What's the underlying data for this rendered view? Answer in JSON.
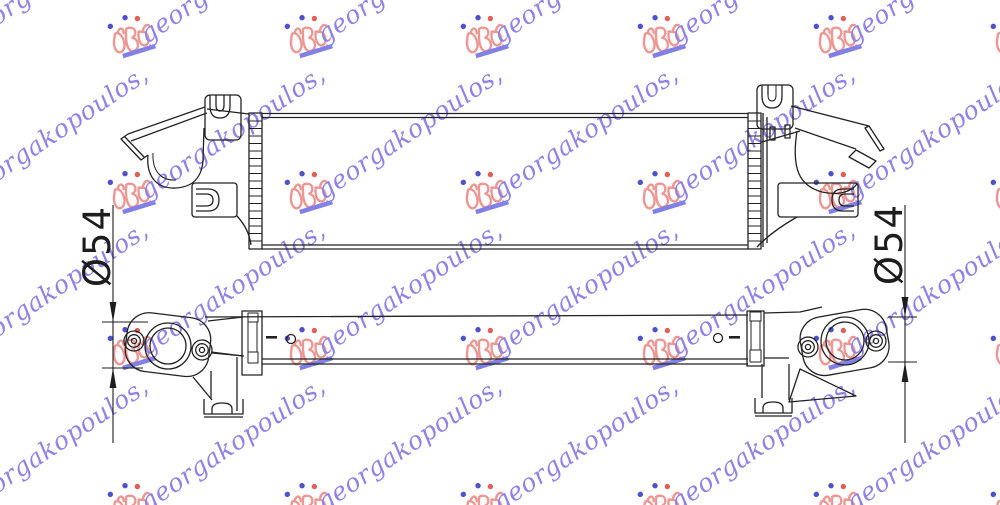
{
  "watermark": {
    "text": "georgakopoulos,",
    "text_color": "#8b7ce8",
    "logo_color": "#ec928e",
    "dot_blue": "#4747c8",
    "dot_orange": "#e2574c",
    "underline_color": "#7b7be4",
    "rows_y": [
      14,
      170,
      326,
      482
    ],
    "cols_x": [
      -68,
      109,
      286,
      462,
      639,
      815,
      992
    ]
  },
  "drawing": {
    "line_color": "#222222",
    "dimensions": [
      {
        "label": "Ø54",
        "side": "left"
      },
      {
        "label": "Ø54",
        "side": "right"
      }
    ]
  }
}
